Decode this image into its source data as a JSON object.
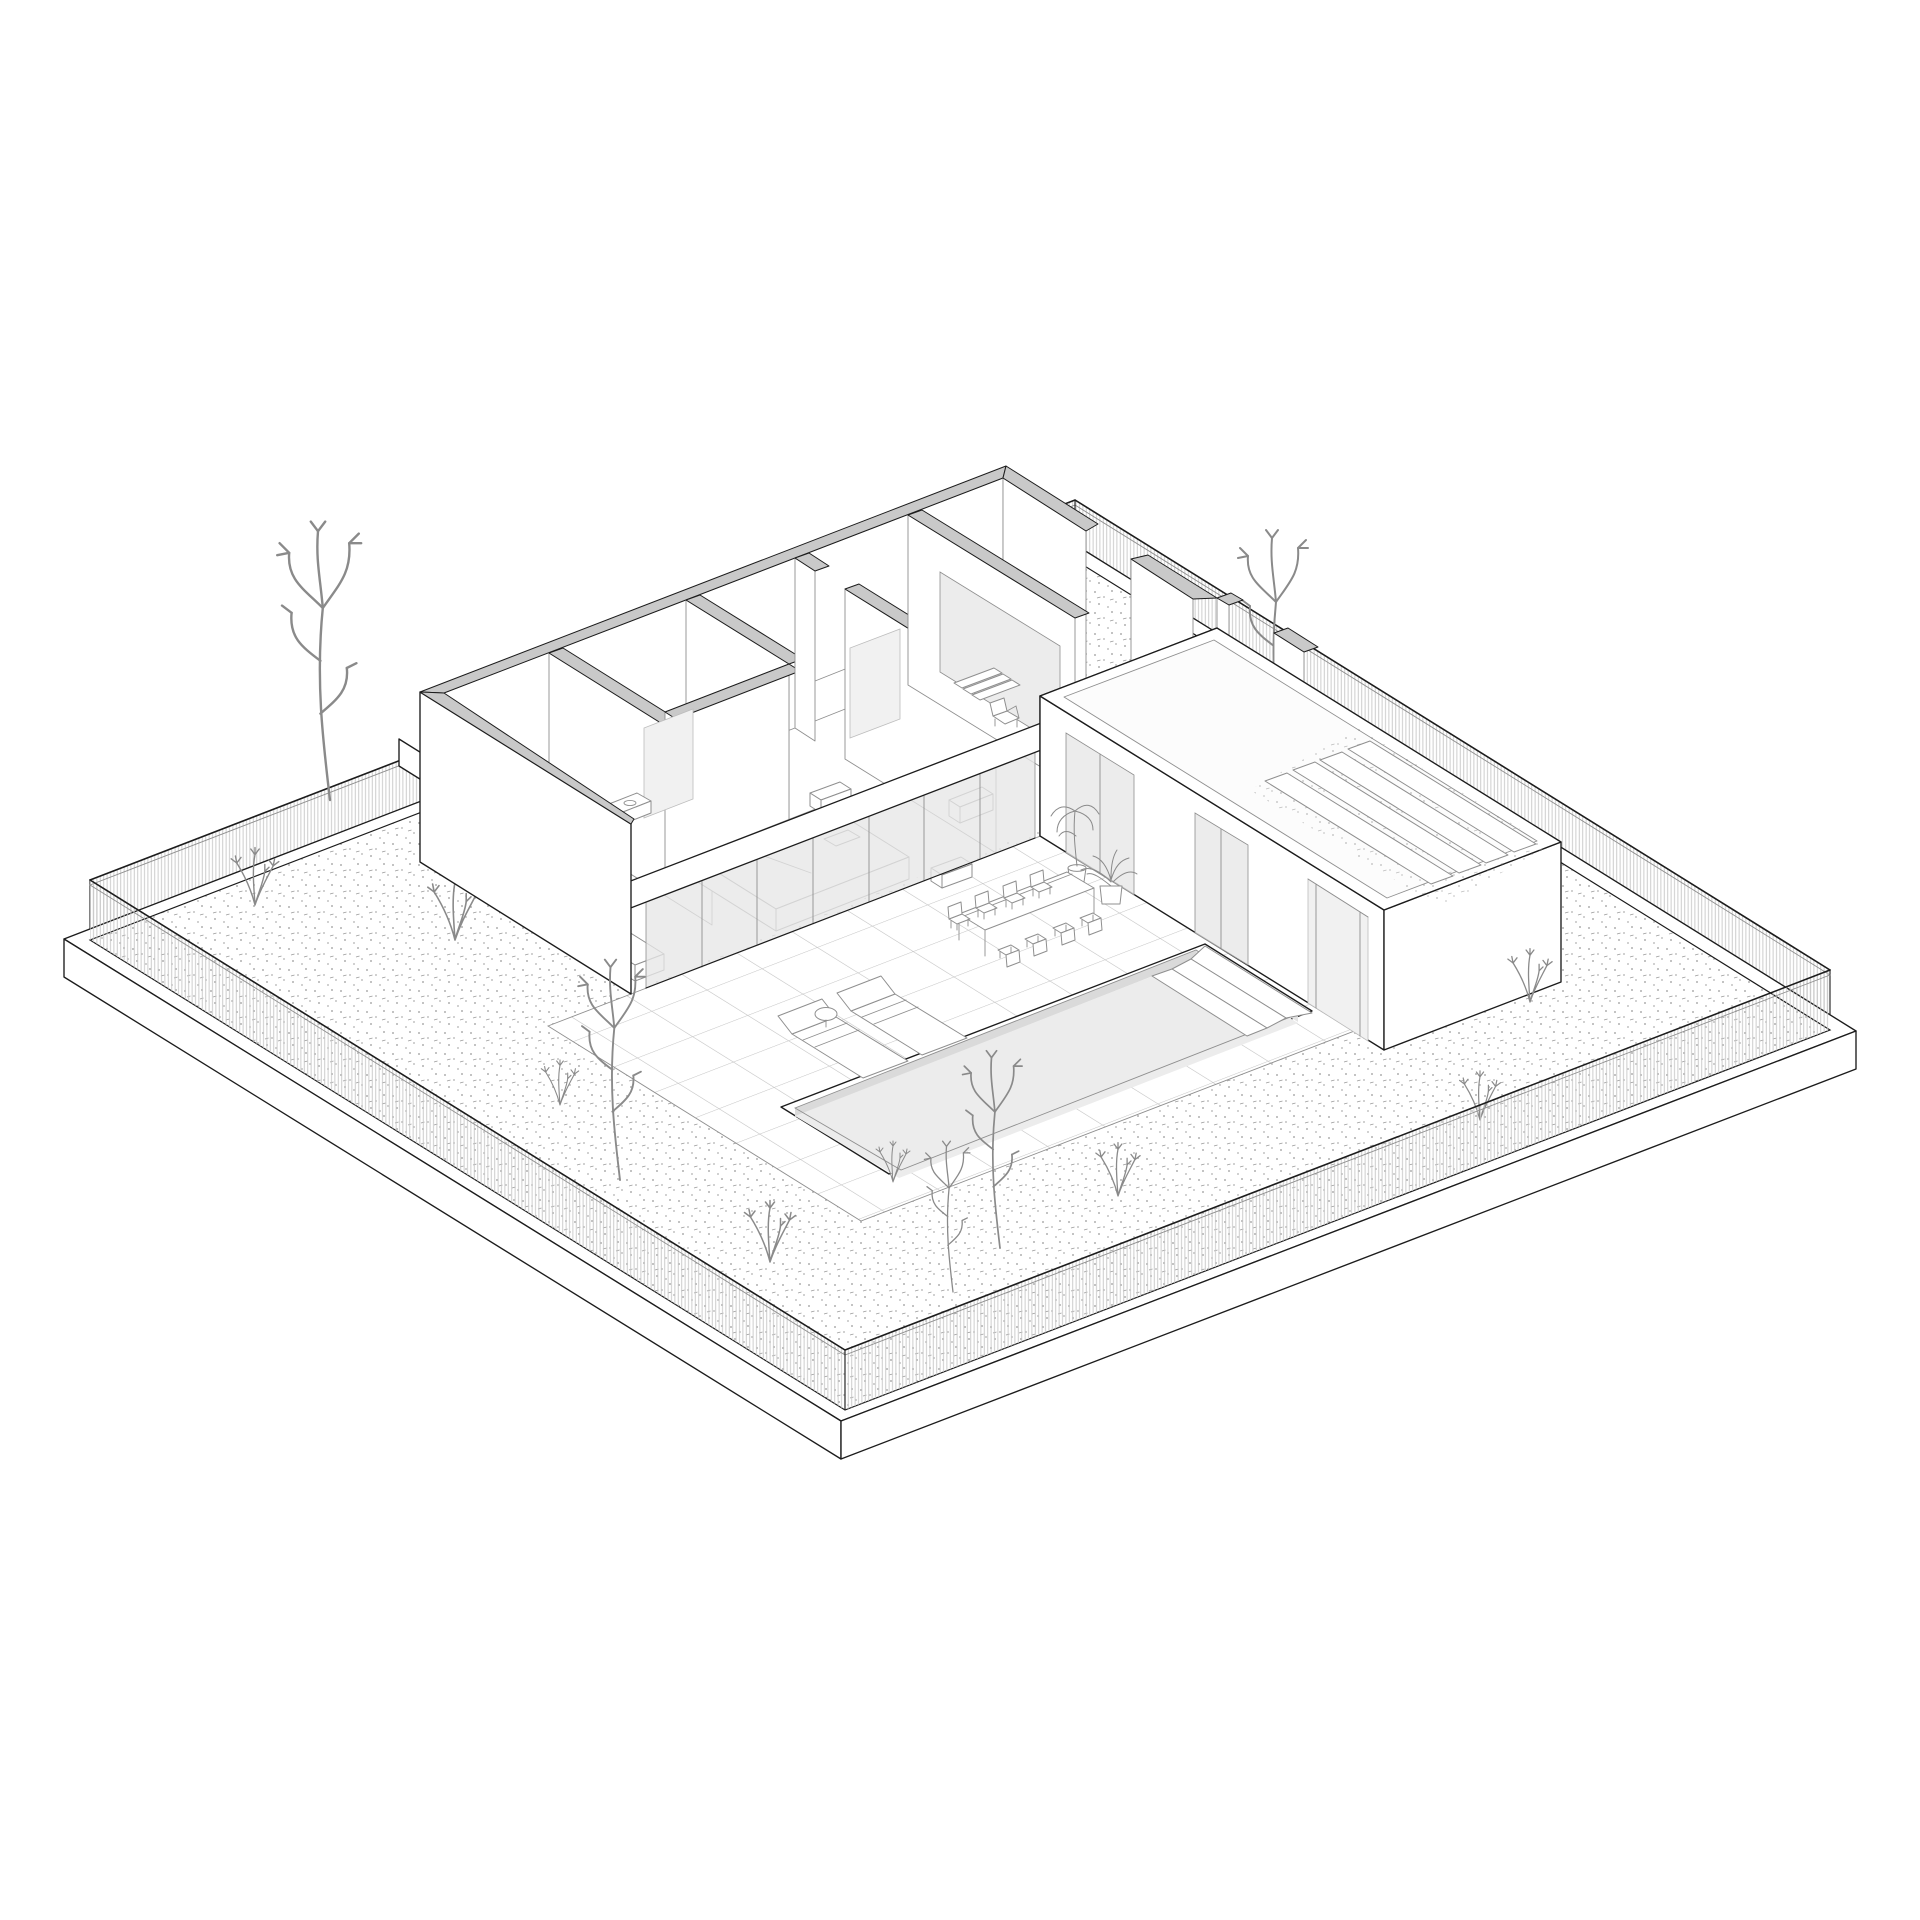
{
  "meta": {
    "title": "Axonometric site drawing",
    "description": "Black-and-white axonometric cutaway drawing of an L-shaped single-storey courtyard house on a square walled plot: slatted perimeter fence on a plinth, gravel garden with wild plants, tiled courtyard, long rectangular swimming pool with corner steps, outdoor dining table with eight chairs, two sun loungers with a side table, potted plants, and a green-roofed annex wing with planter rows.",
    "style": "architectural line drawing, white background",
    "background": "#ffffff"
  },
  "colors": {
    "paper": "#ffffff",
    "line": "#1c1c1c",
    "line-soft": "#8f8f8f",
    "cut": "#c9c9c9",
    "glass": "#e7e7e7",
    "water": "#ececec",
    "pool-wall": "#dadada",
    "hatch": "#c6c6c6",
    "tile": "#c4c4c4",
    "stipple": "#6f6f6f",
    "panel": "#f1f1f1",
    "furniture": "#8f8f8f",
    "plant": "#8a8a8a"
  },
  "site": {
    "plot": "square walled plot on a raised plinth",
    "fence": {
      "type": "vertical slat fence",
      "sides": 4,
      "corner_posts": 4
    },
    "garden": {
      "ground": "gravel stipple texture",
      "trees": 5,
      "shrubs": 9
    }
  },
  "house": {
    "form": "L-shaped single storey shown as horizontal cutaway",
    "main_wing": {
      "rooms": [
        "study",
        "bathroom",
        "master bedroom",
        "second bedroom",
        "entry hall",
        "covered patio"
      ],
      "glazing_panels": 7,
      "furniture": [
        "sofa",
        "washbasin",
        "double bed",
        "2 nightstands",
        "wardrobe panels",
        "dresser",
        "2 armchairs",
        "entry steps"
      ]
    },
    "annex_wing": {
      "features": [
        "two sliding glass doors",
        "garden passage opening",
        "parapet green roof"
      ],
      "green_roof_planters": 4
    }
  },
  "courtyard": {
    "paving": "large square tile grid",
    "pool": {
      "shape": "long rectangle",
      "steps": 3
    },
    "dining_set": {
      "tables": 1,
      "chairs": 8
    },
    "loungers": 2,
    "side_tables": 1,
    "potted_plants": 2
  }
}
